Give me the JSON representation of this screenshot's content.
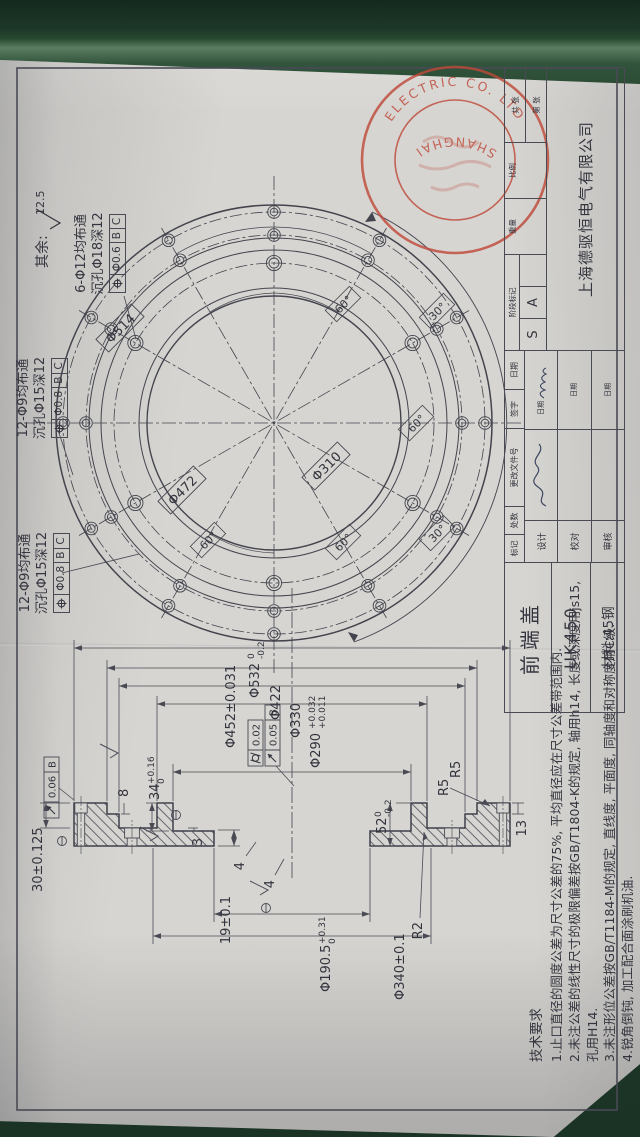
{
  "scene": {
    "paper_color": "#d6d5d1"
  },
  "note": {
    "prefix": "其余:",
    "value": "12.5"
  },
  "callouts": {
    "a": {
      "line1": "12-Φ9均布通",
      "line2": "沉孔Φ15深12",
      "fcf": {
        "tol": "Φ0.8",
        "d1": "B",
        "d2": "C"
      }
    },
    "b": {
      "line1": "12-Φ9均布通",
      "line2": "沉孔Φ15深12",
      "fcf": {
        "tol": "Φ0.8",
        "d1": "B",
        "d2": "C"
      }
    },
    "c": {
      "line1": "6-Φ12均布通",
      "line2": "沉孔Φ18深12",
      "fcf": {
        "tol": "Φ0.6",
        "d1": "B",
        "d2": "C"
      }
    }
  },
  "plan": {
    "dia1": "Φ514",
    "dia2": "Φ472",
    "dia3": "Φ310",
    "angles": [
      "60°",
      "60°",
      "60°",
      "60°",
      "30°",
      "30°"
    ]
  },
  "section": {
    "phi532": {
      "d": "Φ532",
      "u": "0",
      "l": "-0.2"
    },
    "phi452": "Φ452±0.031",
    "phi422": "Φ422",
    "phi330": "Φ330",
    "phi290": {
      "d": "Φ290",
      "u": "+0.032",
      "l": "+0.011"
    },
    "phi190": {
      "d": "Φ190.5",
      "u": "+0.31",
      "l": "0"
    },
    "phi340": "Φ340±0.1",
    "t52": {
      "d": "52",
      "u": "0",
      "l": "-0.2"
    },
    "t34": {
      "d": "34",
      "u": "+0.16",
      "l": "0"
    },
    "t30": "30±0.125",
    "t19": "19±0.1",
    "t13": "13",
    "t8": "8",
    "t3": "3",
    "t4a": "4",
    "t4b": "4",
    "r2": "R2",
    "r5a": "R5",
    "r5b": "R5",
    "fcf_flange": {
      "tol": "0.06",
      "datum": "B"
    },
    "fcf_cyl": {
      "tol": "0.02"
    },
    "fcf_bore": {
      "tol": "0.05",
      "datum": "B"
    }
  },
  "tech": {
    "title": "技术要求",
    "items": [
      "1.止口直径的圆度公差为尺寸公差的75%, 平均直径应在尺寸公差带范围内.",
      "2.未注公差的线性尺寸的极限偏差按GB/T1804-K的规定, 轴用h14, 长度或深度用js15, 孔用H14.",
      "3.未注形位公差按GB/T1184-M的规定, 直线度, 平面度, 同轴度和对称度用C级.",
      "4.锐角倒钝, 加工配合面涂刷机油."
    ]
  },
  "title_block": {
    "part_name": "前端盖",
    "model": "UK450",
    "material": "材料:45钢",
    "company": "上海德驱恒电气有限公司",
    "stage_label": "阶段标记",
    "weight_label": "重量",
    "scale_label": "比例",
    "stage1": "S",
    "stage2": "A",
    "sheet_total": "共 张",
    "sheet_no": "第 张",
    "rev": [
      "标记",
      "处数",
      "更改文件号",
      "签字",
      "日期"
    ],
    "row1": "设计",
    "row2": "校对",
    "row3": "审核",
    "date_label": "日期"
  },
  "stamp": {
    "arc_top": "ELECTRIC CO. LTD",
    "arc_bottom": "SHANGHAI"
  }
}
